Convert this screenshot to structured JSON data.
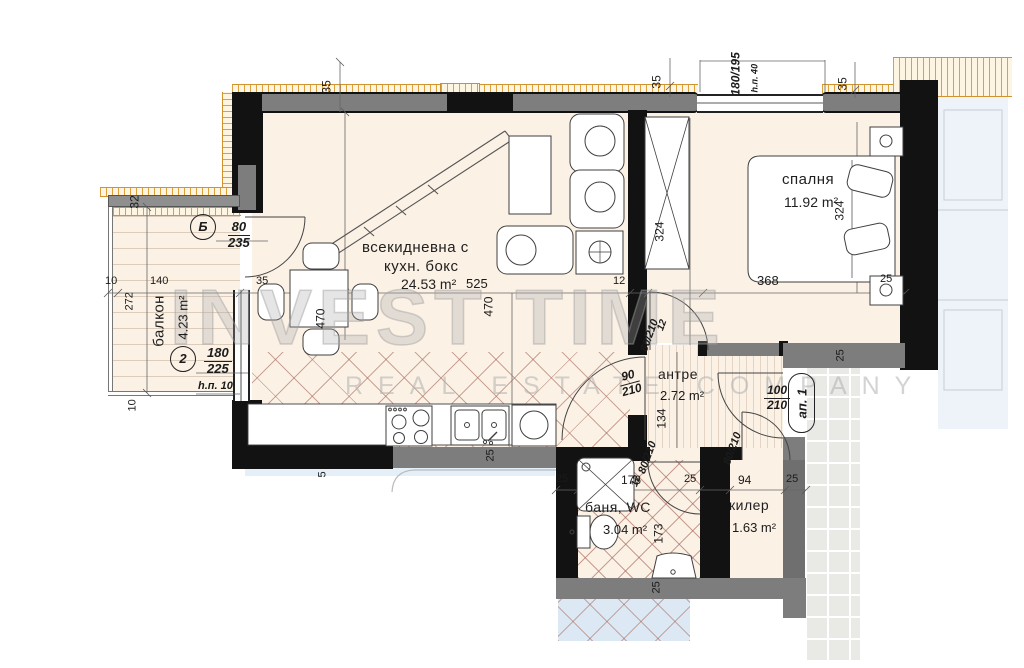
{
  "watermark": {
    "line1": "INVEST TIME",
    "line2": "REAL ESTATE COMPANY"
  },
  "rooms": {
    "living": {
      "name_line1": "всекидневна с",
      "name_line2": "кухн. бокс",
      "area": "24.53 m²"
    },
    "bedroom": {
      "name": "спалня",
      "area": "11.92 m²"
    },
    "balcony": {
      "name": "балкон",
      "area": "4.23 m²"
    },
    "hallway": {
      "name": "антре",
      "area": "2.72 m²"
    },
    "bathroom": {
      "name": "баня, WC",
      "area": "3.04 m²"
    },
    "closet": {
      "name": "килер",
      "area": "1.63 m²"
    }
  },
  "openings": {
    "balcony_door": {
      "id": "Б",
      "spec_top": "80",
      "spec_bottom": "235"
    },
    "balcony_window": {
      "id": "2",
      "spec_top": "180",
      "spec_bottom": "225",
      "sill": "h.п. 10"
    },
    "bedroom_window": {
      "spec": "180/195",
      "sill": "h.п. 40"
    },
    "entrance_door": {
      "id": "ап. 1",
      "spec_top": "100",
      "spec_bottom": "210"
    },
    "hall_bedroom_door": {
      "spec": "80/210"
    },
    "hall_living_door": {
      "spec_top": "90",
      "spec_bottom": "210"
    },
    "bathroom_door": {
      "spec": "80/210"
    },
    "closet_door": {
      "spec": "80/210"
    }
  },
  "dimensions": {
    "top_wall_a": "35",
    "top_wall_b": "35",
    "top_wall_c": "35",
    "balcony_wall": "32",
    "balcony_offset": "10",
    "balcony_width": "140",
    "balcony_depth": "272",
    "balcony_bottom": "10",
    "living_wall_west": "35",
    "living_width": "525",
    "living_depth_a": "470",
    "living_depth_b": "470",
    "partition": "12",
    "hall_wall_a": "12",
    "hall_wall_b": "12",
    "bedroom_width": "368",
    "wardrobe_length": "324",
    "bed_length": "324",
    "bedroom_wall": "25",
    "hall_height": "134",
    "bath_wall_a": "25",
    "bath_width": "176",
    "bath_wall_b": "25",
    "closet_width": "94",
    "bath_wall_c": "25",
    "bath_depth": "173",
    "bath_wall_d": "25",
    "kitchen_wall": "5",
    "kitchen_wall_b": "25",
    "entry_wall": "25"
  }
}
